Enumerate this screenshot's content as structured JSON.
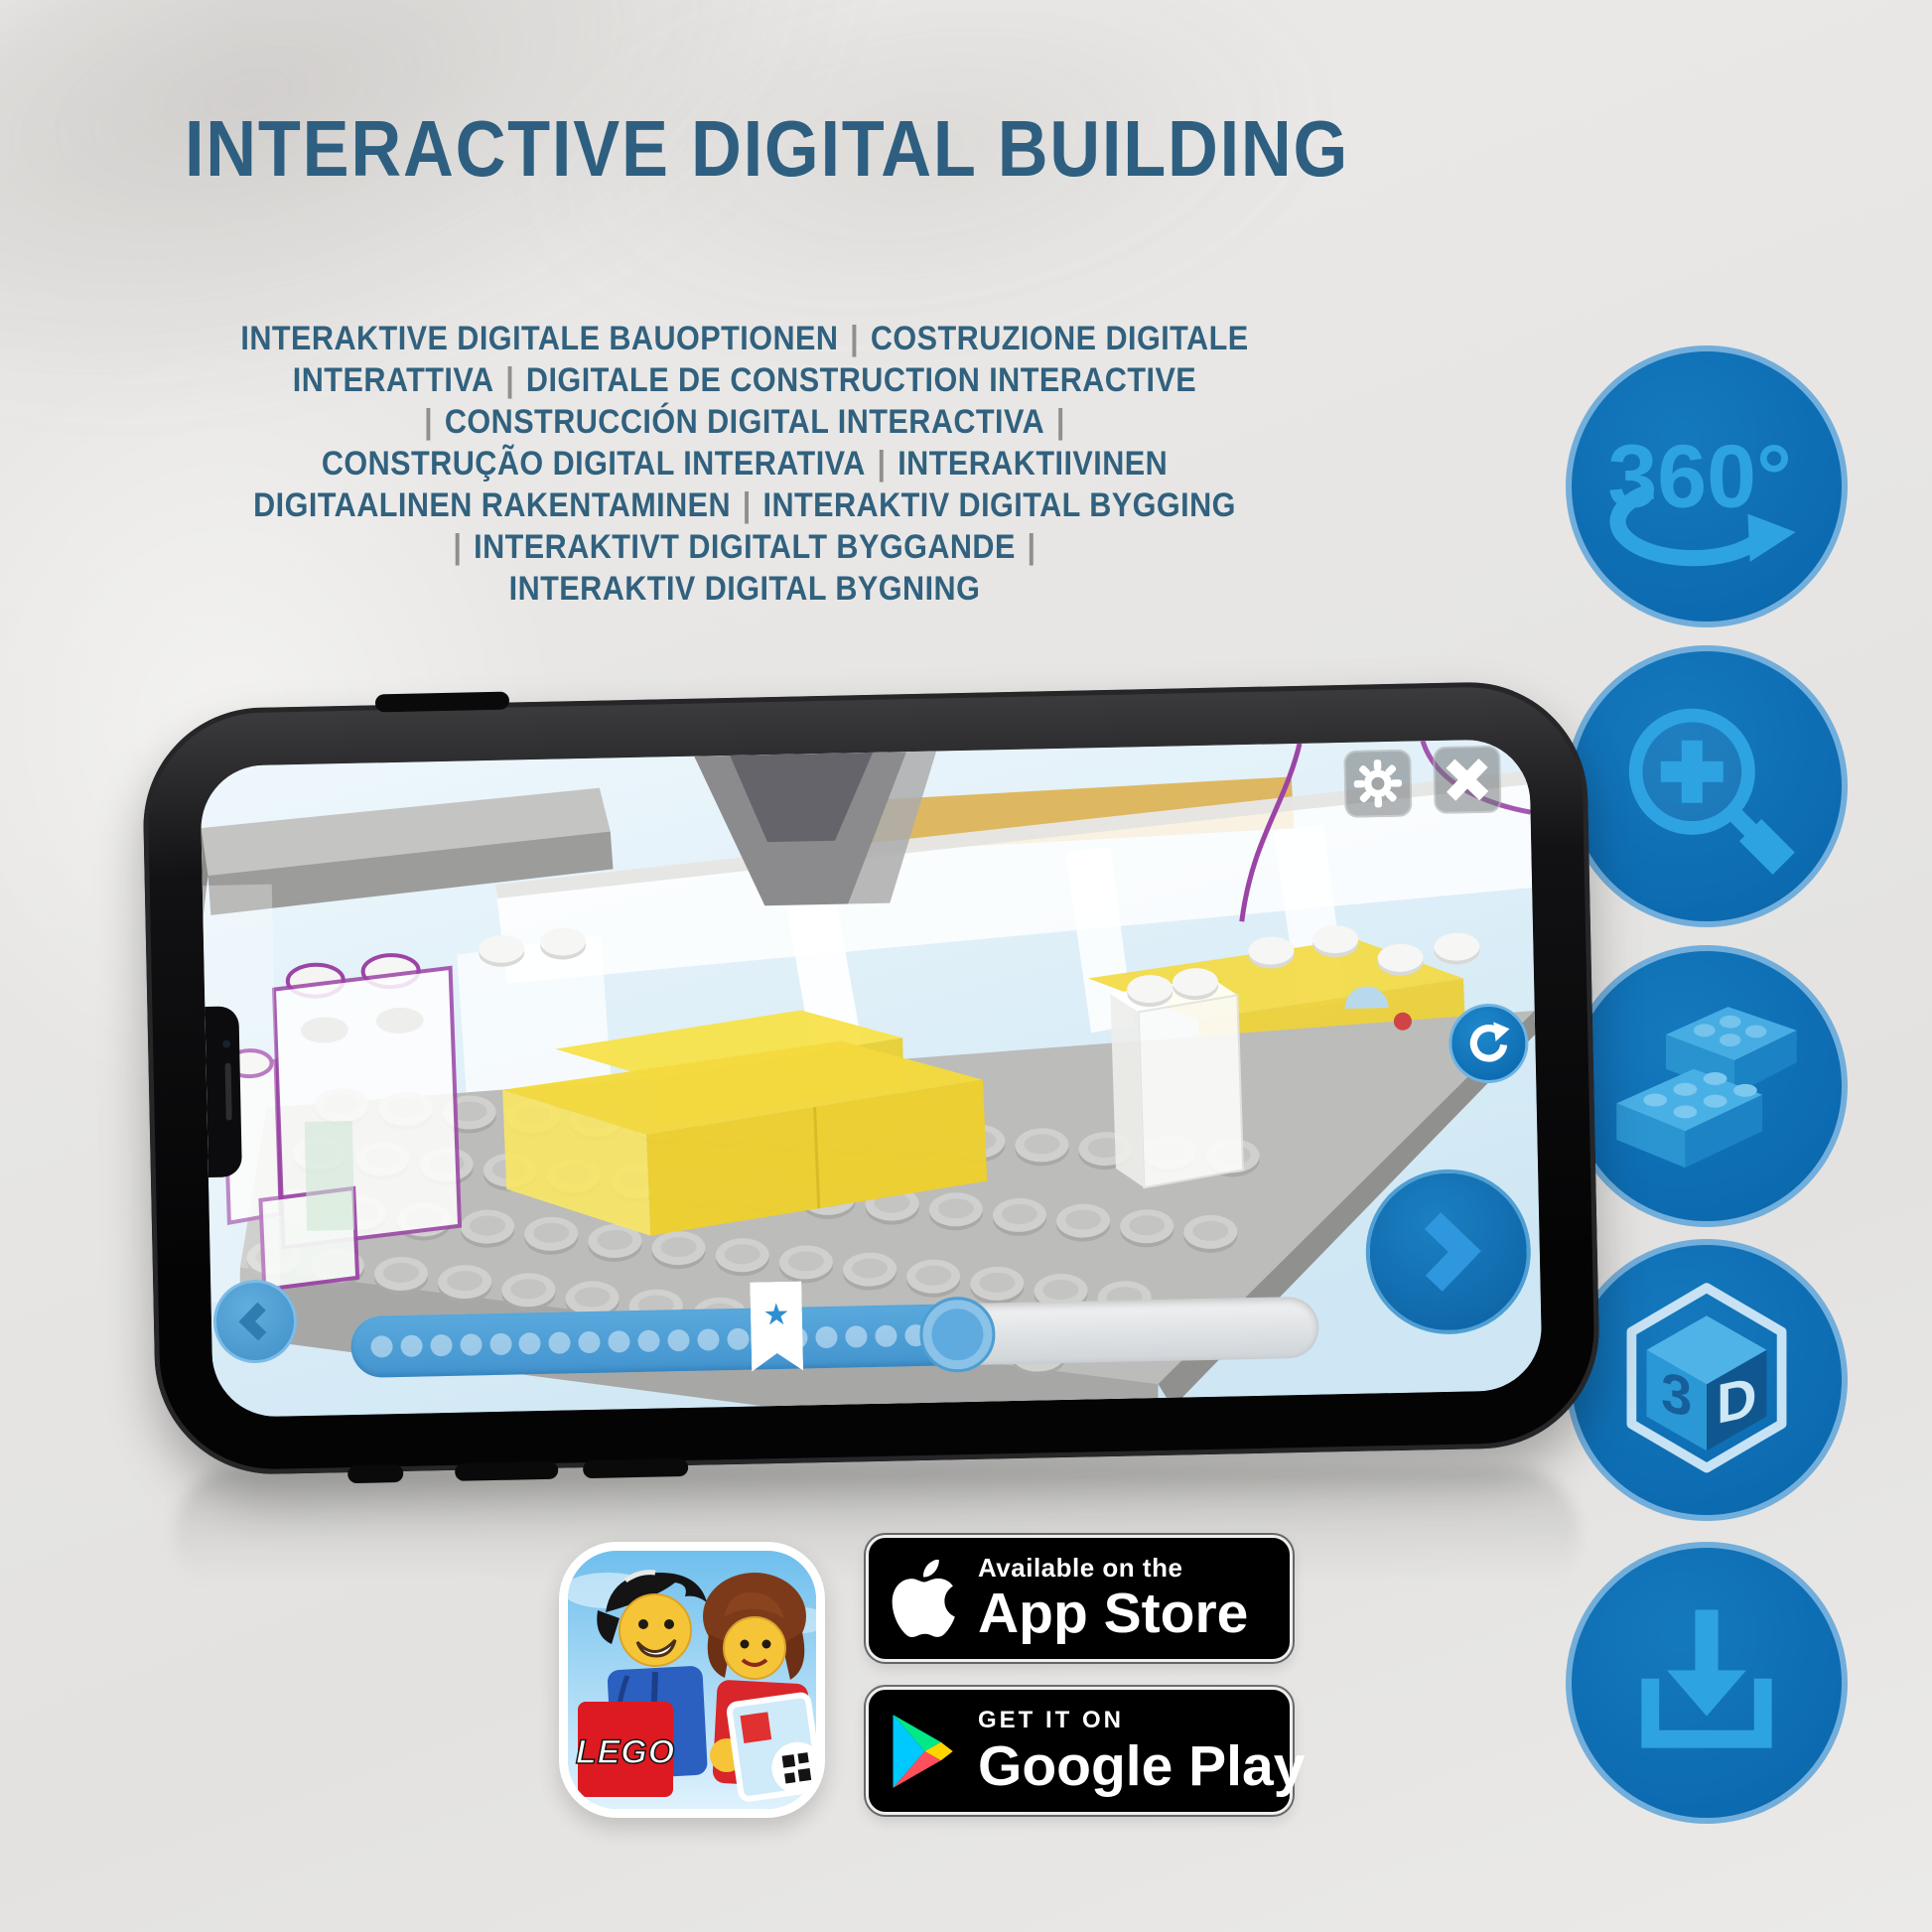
{
  "page": {
    "title": "INTERACTIVE DIGITAL BUILDING"
  },
  "languages": {
    "lines": [
      "INTERAKTIVE DIGITALE BAUOPTIONEN | COSTRUZIONE DIGITALE",
      "INTERATTIVA | DIGITALE DE CONSTRUCTION INTERACTIVE",
      "| CONSTRUCCIÓN DIGITAL INTERACTIVA |",
      "CONSTRUÇÃO DIGITAL INTERATIVA | INTERAKTIIVINEN",
      "DIGITAALINEN RAKENTAMINEN | INTERAKTIV DIGITAL BYGGING",
      "| INTERAKTIVT DIGITALT BYGGANDE |",
      "INTERAKTIV DIGITAL BYGNING"
    ]
  },
  "feature_icons": [
    {
      "name": "360-rotation",
      "label": "360°"
    },
    {
      "name": "zoom-in-magnifier",
      "label": ""
    },
    {
      "name": "building-bricks",
      "label": ""
    },
    {
      "name": "3d-view",
      "face_left": "3",
      "face_right": "D"
    },
    {
      "name": "download",
      "label": ""
    }
  ],
  "phone": {
    "progress": {
      "dot_count": 20,
      "bookmark_star": "★"
    }
  },
  "app_icon": {
    "logo_text": "LEGO"
  },
  "store_badges": {
    "app_store": {
      "line1": "Available on the",
      "line2": "App Store"
    },
    "google_play": {
      "line1": "GET IT ON",
      "line2": "Google Play"
    }
  },
  "colors": {
    "heading_blue": "#2e5f80",
    "separator_gray": "#8f8f8f",
    "circle_blue": "#0d6cb2",
    "circle_rim": "#72aedb",
    "glyph_blue": "#2ea3e2",
    "brick_yellow": "#f2d73e",
    "outline_purple": "#9b44a6",
    "screen_blue": "#d9edf8"
  }
}
